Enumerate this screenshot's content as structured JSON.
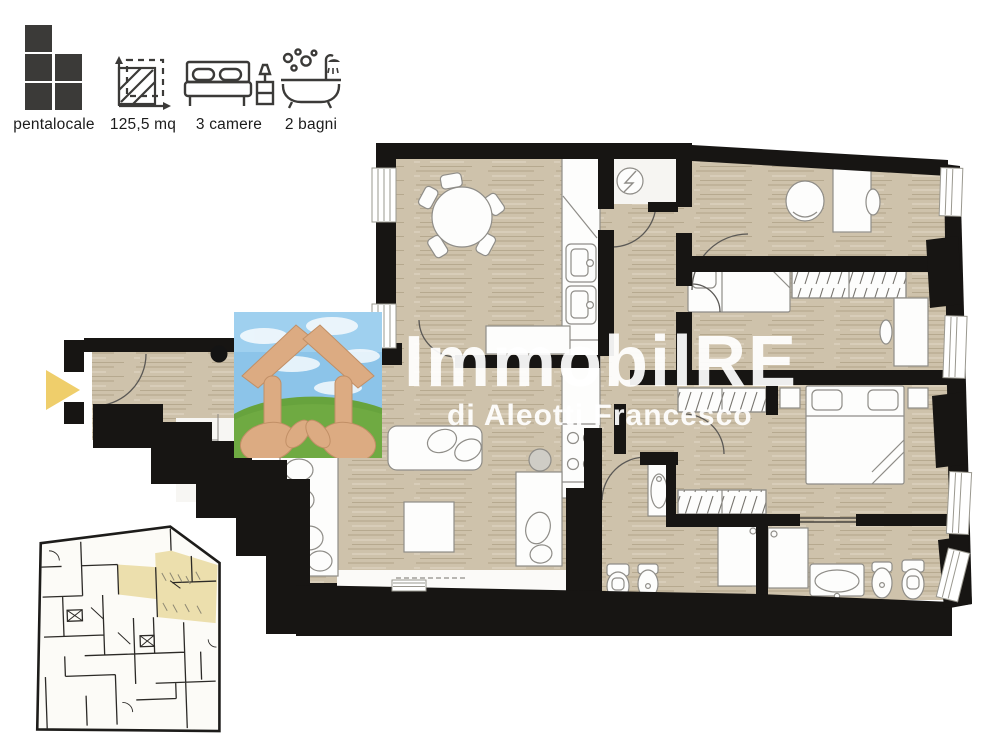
{
  "legend": {
    "items": [
      {
        "id": "type",
        "icon": "pentalocale-icon",
        "label": "pentalocale"
      },
      {
        "id": "area",
        "icon": "area-icon",
        "label": "125,5 mq"
      },
      {
        "id": "rooms",
        "icon": "bed-icon",
        "label": "3 camere"
      },
      {
        "id": "baths",
        "icon": "bath-icon",
        "label": "2 bagni"
      }
    ]
  },
  "watermark": {
    "brand": "ImmobilRE",
    "subtitle": "di Aleotti Francesco"
  },
  "colors": {
    "floor_wood": "#cec2ab",
    "wall_black": "#171513",
    "furniture_white": "#fdfdfc",
    "entrance_arrow_yellow": "#efce6b",
    "keyplan_highlight_yellow": "#ecdfad",
    "legend_icon_dark": "#3b3a38",
    "watermark_white": "#ffffff",
    "photo_sky_blue": "#8cc4e9",
    "photo_grass_green": "#67a33d",
    "photo_hands_skin": "#dcab82"
  }
}
